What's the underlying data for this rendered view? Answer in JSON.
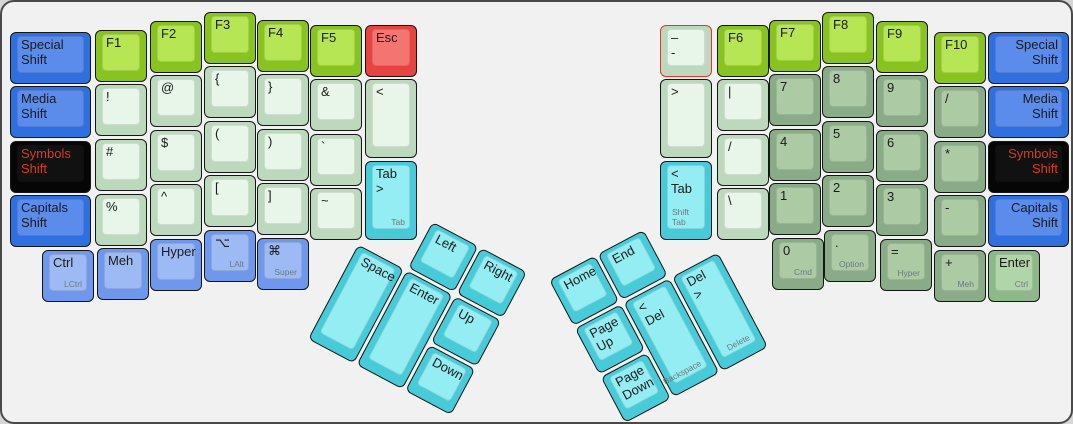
{
  "app": {
    "description": "ErgoDox keyboard layout with two rotated thumb clusters",
    "canvas": {
      "background": "#f1f1f1",
      "border_color": "#4a4a4a",
      "page_background": "#d6d6d6",
      "selection_outline": "#e8322c",
      "label_color": "#1b1b1b",
      "label_red": "#d8391f",
      "sublabel_color": "#6a7a80"
    }
  },
  "palette": {
    "blue": {
      "base": "#2f6fe0",
      "top": "#5b8cec"
    },
    "lavender": {
      "base": "#6f97ee",
      "top": "#9dbaf4"
    },
    "black": {
      "base": "#060606",
      "top": "#111111"
    },
    "red": {
      "base": "#e84341",
      "top": "#f47471"
    },
    "green": {
      "base": "#88c31e",
      "top": "#b6e654"
    },
    "pale": {
      "base": "#bcd8bd",
      "top": "#e7f6e9"
    },
    "sage": {
      "base": "#8aab88",
      "top": "#accaa4"
    },
    "entergreen": {
      "base": "#8db98a",
      "top": "#b0d5a9"
    },
    "cyan": {
      "base": "#46cbd9",
      "top": "#93edf2"
    }
  },
  "keys": [
    {
      "name": "key-special-shift-left",
      "label": "Special Shift",
      "x": 8,
      "y": 30,
      "w": 81,
      "h": 52,
      "color": "blue"
    },
    {
      "name": "key-media-shift-left",
      "label": "Media Shift",
      "x": 8,
      "y": 84,
      "w": 81,
      "h": 52,
      "color": "blue"
    },
    {
      "name": "key-symbols-shift-left",
      "label": "Symbols Shift",
      "x": 8,
      "y": 139,
      "w": 81,
      "h": 52,
      "color": "black",
      "labelRed": true
    },
    {
      "name": "key-capitals-shift-left",
      "label": "Capitals Shift",
      "x": 8,
      "y": 193,
      "w": 81,
      "h": 52,
      "color": "blue"
    },
    {
      "name": "key-f1",
      "label": "F1",
      "x": 93,
      "y": 28,
      "w": 52,
      "h": 52,
      "color": "green"
    },
    {
      "name": "key-exclamation",
      "label": "!",
      "x": 93,
      "y": 82,
      "w": 52,
      "h": 52,
      "color": "pale"
    },
    {
      "name": "key-hash",
      "label": "#",
      "x": 93,
      "y": 137,
      "w": 52,
      "h": 52,
      "color": "pale"
    },
    {
      "name": "key-percent",
      "label": "%",
      "x": 93,
      "y": 192,
      "w": 52,
      "h": 52,
      "color": "pale"
    },
    {
      "name": "key-f2",
      "label": "F2",
      "x": 148,
      "y": 19,
      "w": 52,
      "h": 52,
      "color": "green"
    },
    {
      "name": "key-at",
      "label": "@",
      "x": 148,
      "y": 73,
      "w": 52,
      "h": 52,
      "color": "pale"
    },
    {
      "name": "key-dollar",
      "label": "$",
      "x": 148,
      "y": 128,
      "w": 52,
      "h": 52,
      "color": "pale"
    },
    {
      "name": "key-caret",
      "label": "^",
      "x": 148,
      "y": 182,
      "w": 52,
      "h": 52,
      "color": "pale"
    },
    {
      "name": "key-f3",
      "label": "F3",
      "x": 202,
      "y": 10,
      "w": 52,
      "h": 52,
      "color": "green"
    },
    {
      "name": "key-lbrace",
      "label": "{",
      "x": 202,
      "y": 64,
      "w": 52,
      "h": 52,
      "color": "pale"
    },
    {
      "name": "key-lparen",
      "label": "(",
      "x": 202,
      "y": 119,
      "w": 52,
      "h": 52,
      "color": "pale"
    },
    {
      "name": "key-lbracket",
      "label": "[",
      "x": 202,
      "y": 173,
      "w": 52,
      "h": 52,
      "color": "pale"
    },
    {
      "name": "key-f4",
      "label": "F4",
      "x": 255,
      "y": 18,
      "w": 52,
      "h": 52,
      "color": "green"
    },
    {
      "name": "key-rbrace",
      "label": "}",
      "x": 255,
      "y": 72,
      "w": 52,
      "h": 52,
      "color": "pale"
    },
    {
      "name": "key-rparen",
      "label": ")",
      "x": 255,
      "y": 127,
      "w": 52,
      "h": 52,
      "color": "pale"
    },
    {
      "name": "key-rbracket",
      "label": "]",
      "x": 255,
      "y": 181,
      "w": 52,
      "h": 52,
      "color": "pale"
    },
    {
      "name": "key-f5",
      "label": "F5",
      "x": 308,
      "y": 23,
      "w": 52,
      "h": 52,
      "color": "green"
    },
    {
      "name": "key-ampersand",
      "label": "&",
      "x": 308,
      "y": 77,
      "w": 52,
      "h": 52,
      "color": "pale"
    },
    {
      "name": "key-backtick",
      "label": "`",
      "x": 308,
      "y": 132,
      "w": 52,
      "h": 52,
      "color": "pale"
    },
    {
      "name": "key-tilde",
      "label": "~",
      "x": 308,
      "y": 186,
      "w": 52,
      "h": 52,
      "color": "pale"
    },
    {
      "name": "key-esc",
      "label": "Esc",
      "x": 363,
      "y": 23,
      "w": 52,
      "h": 52,
      "color": "red"
    },
    {
      "name": "key-less-than",
      "label": "<",
      "x": 363,
      "y": 77,
      "w": 52,
      "h": 79,
      "color": "pale"
    },
    {
      "name": "key-tab-forward",
      "label": "Tab >",
      "sub": "Tab",
      "x": 363,
      "y": 159,
      "w": 52,
      "h": 79,
      "color": "cyan"
    },
    {
      "name": "key-ctrl-left",
      "label": "Ctrl",
      "sub": "LCtrl",
      "x": 40,
      "y": 248,
      "w": 52,
      "h": 52,
      "color": "lavender"
    },
    {
      "name": "key-meh-left",
      "label": "Meh",
      "x": 95,
      "y": 246,
      "w": 52,
      "h": 52,
      "color": "lavender"
    },
    {
      "name": "key-hyper-left",
      "label": "Hyper",
      "x": 148,
      "y": 237,
      "w": 52,
      "h": 52,
      "color": "lavender"
    },
    {
      "name": "key-lalt",
      "label": "⌥",
      "sub": "LAlt",
      "x": 202,
      "y": 228,
      "w": 52,
      "h": 52,
      "color": "lavender"
    },
    {
      "name": "key-super",
      "label": "⌘",
      "sub": "Super",
      "x": 255,
      "y": 236,
      "w": 52,
      "h": 52,
      "color": "lavender"
    },
    {
      "name": "key-dash-selected",
      "label": "–\n-",
      "x": 658,
      "y": 23,
      "w": 52,
      "h": 52,
      "color": "pale",
      "selected": true
    },
    {
      "name": "key-greater-than",
      "label": ">",
      "x": 658,
      "y": 77,
      "w": 52,
      "h": 79,
      "color": "pale"
    },
    {
      "name": "key-tab-back",
      "label": "< Tab",
      "sub": "Shift Tab",
      "subAlign": "left",
      "x": 658,
      "y": 159,
      "w": 52,
      "h": 79,
      "color": "cyan"
    },
    {
      "name": "key-f6",
      "label": "F6",
      "x": 715,
      "y": 23,
      "w": 52,
      "h": 52,
      "color": "green"
    },
    {
      "name": "key-pipe",
      "label": "|",
      "x": 715,
      "y": 77,
      "w": 52,
      "h": 52,
      "color": "pale"
    },
    {
      "name": "key-slash",
      "label": "/",
      "x": 715,
      "y": 132,
      "w": 52,
      "h": 52,
      "color": "pale"
    },
    {
      "name": "key-backslash",
      "label": "\\",
      "x": 715,
      "y": 186,
      "w": 52,
      "h": 52,
      "color": "pale"
    },
    {
      "name": "key-f7",
      "label": "F7",
      "x": 767,
      "y": 18,
      "w": 52,
      "h": 52,
      "color": "green"
    },
    {
      "name": "key-7",
      "label": "7",
      "x": 767,
      "y": 72,
      "w": 52,
      "h": 52,
      "color": "sage"
    },
    {
      "name": "key-4",
      "label": "4",
      "x": 767,
      "y": 127,
      "w": 52,
      "h": 52,
      "color": "sage"
    },
    {
      "name": "key-1",
      "label": "1",
      "x": 767,
      "y": 181,
      "w": 52,
      "h": 52,
      "color": "sage"
    },
    {
      "name": "key-f8",
      "label": "F8",
      "x": 820,
      "y": 10,
      "w": 52,
      "h": 52,
      "color": "green"
    },
    {
      "name": "key-8",
      "label": "8",
      "x": 820,
      "y": 64,
      "w": 52,
      "h": 52,
      "color": "sage"
    },
    {
      "name": "key-5",
      "label": "5",
      "x": 820,
      "y": 119,
      "w": 52,
      "h": 52,
      "color": "sage"
    },
    {
      "name": "key-2",
      "label": "2",
      "x": 820,
      "y": 173,
      "w": 52,
      "h": 52,
      "color": "sage"
    },
    {
      "name": "key-f9",
      "label": "F9",
      "x": 874,
      "y": 19,
      "w": 52,
      "h": 52,
      "color": "green"
    },
    {
      "name": "key-9",
      "label": "9",
      "x": 874,
      "y": 73,
      "w": 52,
      "h": 52,
      "color": "sage"
    },
    {
      "name": "key-6",
      "label": "6",
      "x": 874,
      "y": 128,
      "w": 52,
      "h": 52,
      "color": "sage"
    },
    {
      "name": "key-3",
      "label": "3",
      "x": 874,
      "y": 182,
      "w": 52,
      "h": 52,
      "color": "sage"
    },
    {
      "name": "key-f10",
      "label": "F10",
      "x": 932,
      "y": 30,
      "w": 52,
      "h": 52,
      "color": "green"
    },
    {
      "name": "key-slash-numpad",
      "label": "/",
      "x": 932,
      "y": 84,
      "w": 52,
      "h": 52,
      "color": "sage"
    },
    {
      "name": "key-asterisk",
      "label": "*",
      "x": 932,
      "y": 139,
      "w": 52,
      "h": 52,
      "color": "sage"
    },
    {
      "name": "key-minus",
      "label": "-",
      "x": 932,
      "y": 193,
      "w": 52,
      "h": 52,
      "color": "sage"
    },
    {
      "name": "key-special-shift-right",
      "label": "Special Shift",
      "x": 986,
      "y": 30,
      "w": 81,
      "h": 52,
      "color": "blue",
      "align": "right"
    },
    {
      "name": "key-media-shift-right",
      "label": "Media Shift",
      "x": 986,
      "y": 84,
      "w": 81,
      "h": 52,
      "color": "blue",
      "align": "right"
    },
    {
      "name": "key-symbols-shift-right",
      "label": "Symbols Shift",
      "x": 986,
      "y": 139,
      "w": 81,
      "h": 52,
      "color": "black",
      "align": "right",
      "labelRed": true
    },
    {
      "name": "key-capitals-shift-right",
      "label": "Capitals Shift",
      "x": 986,
      "y": 193,
      "w": 81,
      "h": 52,
      "color": "blue",
      "align": "right"
    },
    {
      "name": "key-0",
      "label": "0",
      "sub": "Cmd",
      "x": 770,
      "y": 236,
      "w": 52,
      "h": 52,
      "color": "sage"
    },
    {
      "name": "key-dot",
      "label": ".",
      "sub": "Option",
      "x": 822,
      "y": 228,
      "w": 52,
      "h": 52,
      "color": "sage"
    },
    {
      "name": "key-equals",
      "label": "=",
      "sub": "Hyper",
      "x": 878,
      "y": 237,
      "w": 52,
      "h": 52,
      "color": "sage"
    },
    {
      "name": "key-plus",
      "label": "+",
      "sub": "Meh",
      "x": 932,
      "y": 248,
      "w": 52,
      "h": 52,
      "color": "sage"
    },
    {
      "name": "key-enter-right",
      "label": "Enter",
      "sub": "Ctrl",
      "x": 986,
      "y": 248,
      "w": 52,
      "h": 52,
      "color": "entergreen"
    }
  ],
  "clusters": [
    {
      "name": "left-thumb-cluster",
      "x": 382,
      "y": 194,
      "angle": 28,
      "keys": [
        {
          "name": "key-left-arrow",
          "label": "Left",
          "x": 55,
          "y": 0,
          "w": 52,
          "h": 52,
          "color": "cyan"
        },
        {
          "name": "key-right-arrow",
          "label": "Right",
          "x": 110,
          "y": 0,
          "w": 52,
          "h": 52,
          "color": "cyan"
        },
        {
          "name": "key-space",
          "label": "Space",
          "x": 0,
          "y": 55,
          "w": 52,
          "h": 107,
          "color": "cyan"
        },
        {
          "name": "key-enter-thumb",
          "label": "Enter",
          "x": 55,
          "y": 55,
          "w": 52,
          "h": 107,
          "color": "cyan"
        },
        {
          "name": "key-up-arrow",
          "label": "Up",
          "x": 110,
          "y": 55,
          "w": 52,
          "h": 52,
          "color": "cyan"
        },
        {
          "name": "key-down-arrow",
          "label": "Down",
          "x": 110,
          "y": 110,
          "w": 52,
          "h": 52,
          "color": "cyan"
        }
      ]
    },
    {
      "name": "right-thumb-cluster",
      "x": 547,
      "y": 278,
      "angle": -28,
      "keys": [
        {
          "name": "key-home",
          "label": "Home",
          "x": 0,
          "y": 0,
          "w": 52,
          "h": 52,
          "color": "cyan"
        },
        {
          "name": "key-end",
          "label": "End",
          "x": 55,
          "y": 0,
          "w": 52,
          "h": 52,
          "color": "cyan"
        },
        {
          "name": "key-page-up",
          "label": "Page Up",
          "x": 0,
          "y": 55,
          "w": 52,
          "h": 52,
          "color": "cyan"
        },
        {
          "name": "key-page-down",
          "label": "Page Down",
          "x": 0,
          "y": 110,
          "w": 52,
          "h": 52,
          "color": "cyan"
        },
        {
          "name": "key-backspace",
          "label": "< Del",
          "sub": "Backspace",
          "x": 55,
          "y": 55,
          "w": 52,
          "h": 107,
          "color": "cyan"
        },
        {
          "name": "key-delete",
          "label": "Del >",
          "sub": "Delete",
          "x": 110,
          "y": 55,
          "w": 52,
          "h": 107,
          "color": "cyan"
        }
      ]
    }
  ]
}
